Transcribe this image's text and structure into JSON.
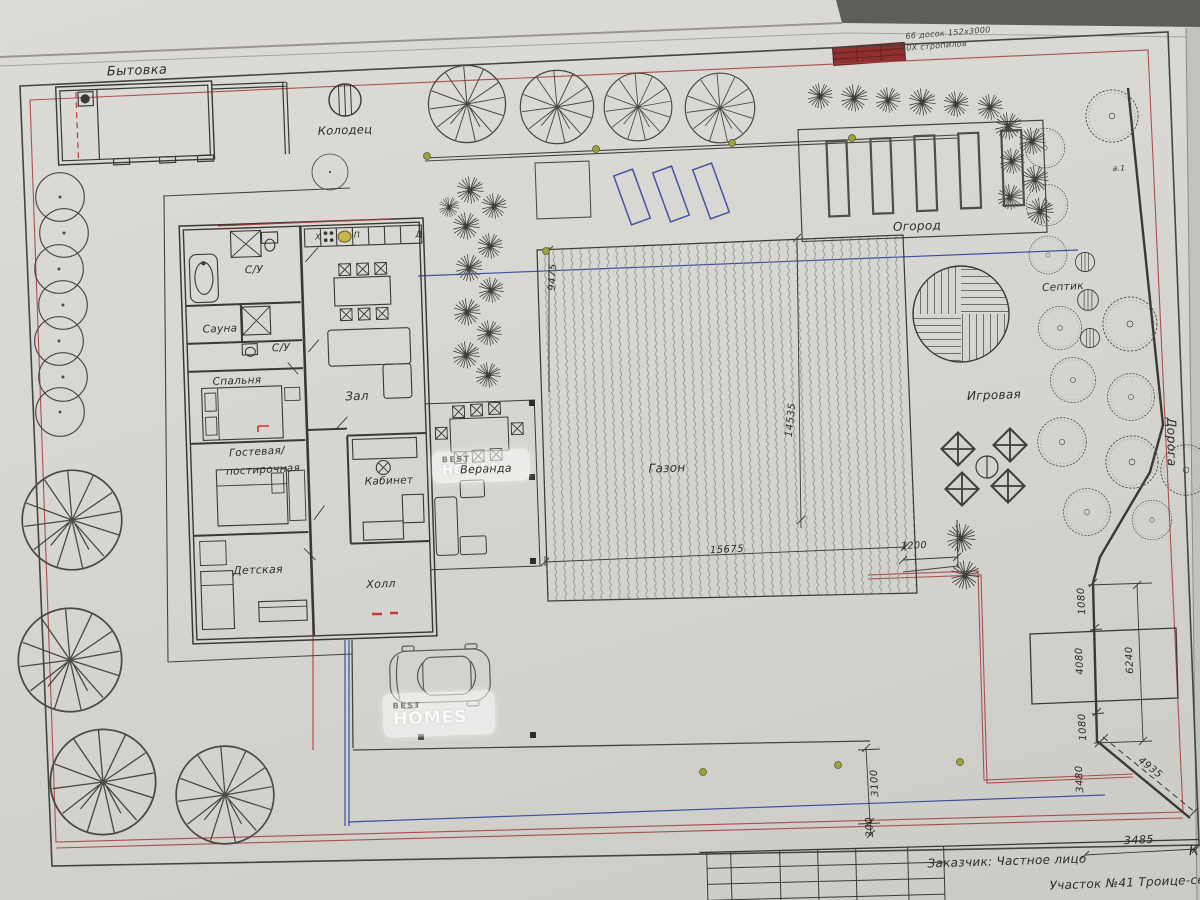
{
  "labels": {
    "bytovka": "Бытовка",
    "kolodec": "Колодец",
    "ogorod": "Огород",
    "septik": "Септик",
    "igrovaya": "Игровая",
    "gazon": "Газон",
    "veranda": "Веранда",
    "doroga": "Дорога",
    "marker_a1": "а.1"
  },
  "rooms": {
    "su1": "С/У",
    "sauna": "Сауна",
    "su2": "С/У",
    "spalnya": "Спальня",
    "zal": "Зал",
    "gostevaya1": "Гостевая/",
    "gostevaya2": "постирочная",
    "kabinet": "Кабинет",
    "detskaya": "Детская",
    "holl": "Холл"
  },
  "kitchen": {
    "x": "Х",
    "p": "П",
    "d": "Д"
  },
  "dimensions": {
    "v9475": "9475",
    "v14535": "14535",
    "h15675": "15675",
    "h1200": "1200",
    "r1080a": "1080",
    "r4080": "4080",
    "r1080b": "1080",
    "r6240": "6240",
    "r3480": "3480",
    "r4935": "4935",
    "b3100": "3100",
    "b300": "300",
    "t3485": "3485"
  },
  "title_block": {
    "client": "Заказчик: Частное лицо",
    "site": "Участок №41 Троице-сельцо",
    "sheet_letter": "К"
  },
  "notes": {
    "line1": "66 досок 152х3000",
    "line2": "60Х стропилов"
  },
  "watermark": {
    "line1": "BEST",
    "line2": "HOMES"
  },
  "colors": {
    "boundary_red": "#a34343",
    "utility_blue": "#3d4fa1",
    "accent_olive": "#99a23b",
    "lumber_red": "#8f2f2f"
  }
}
